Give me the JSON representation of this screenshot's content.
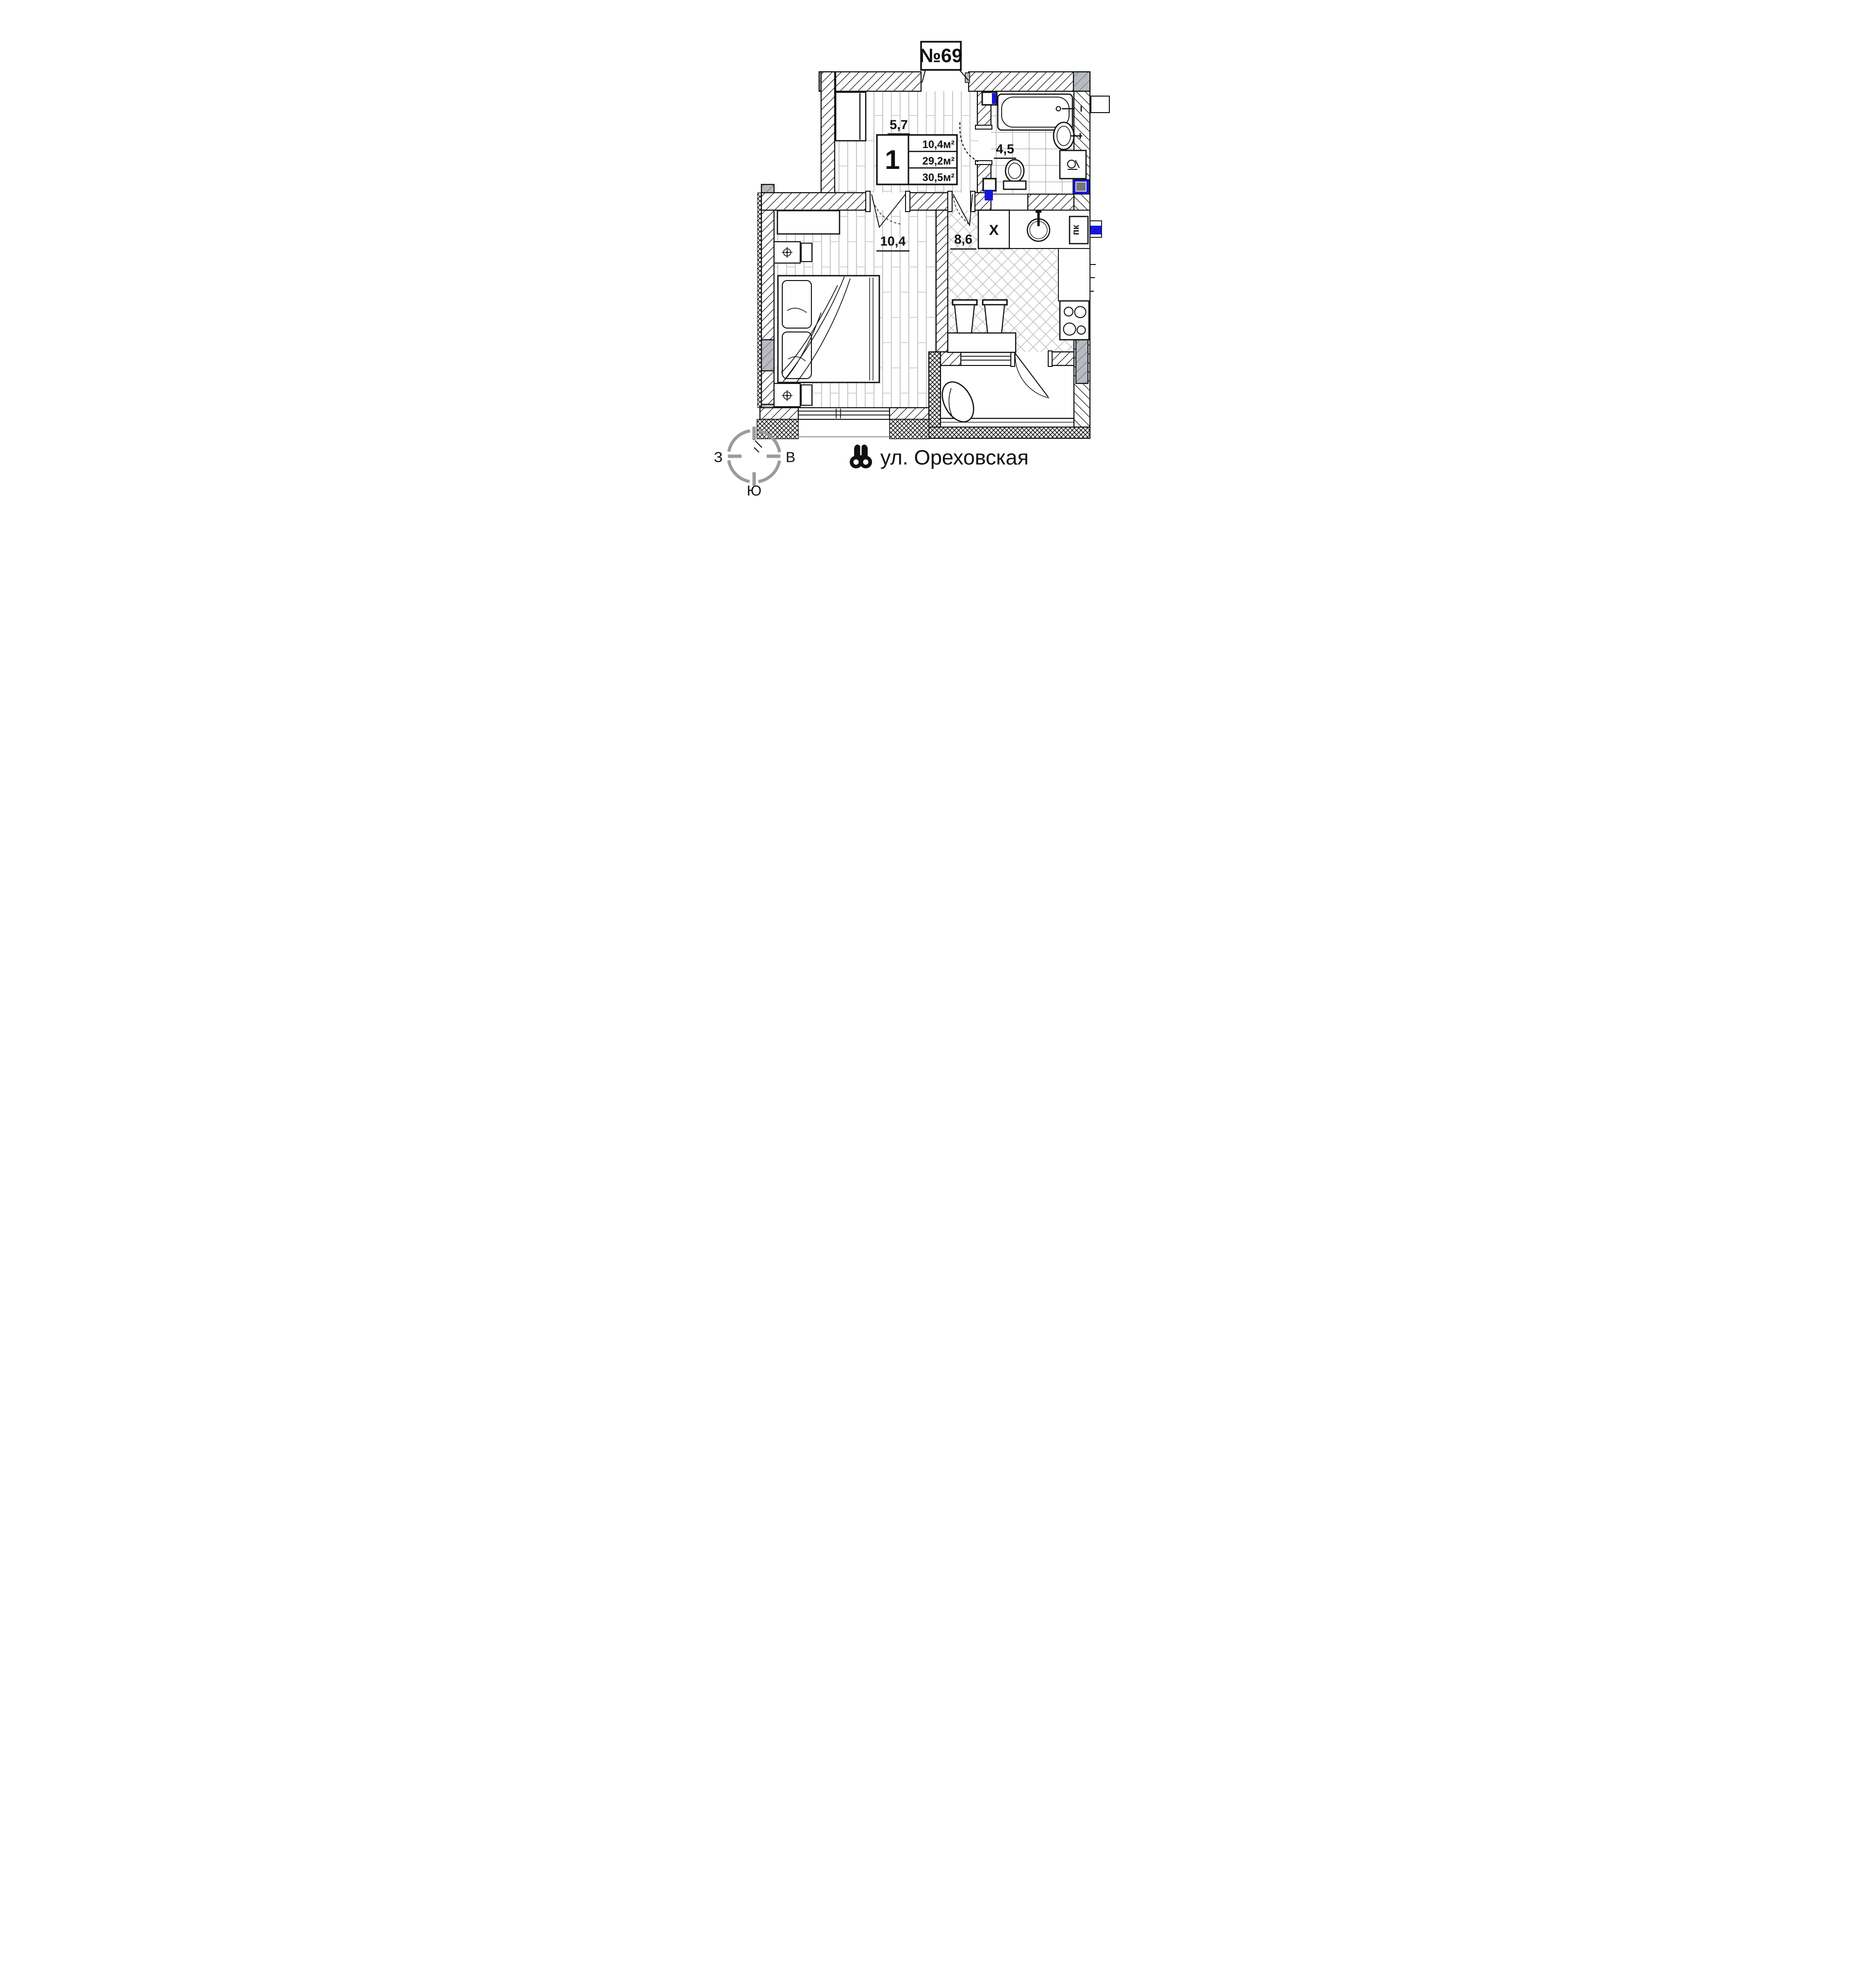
{
  "title": {
    "unit_number": "№69"
  },
  "areas": {
    "hall": "5,7",
    "bathroom": "4,5",
    "bedroom": "10,4",
    "kitchen": "8,6"
  },
  "info_box": {
    "rooms_count": "1",
    "living_area": "10,4м²",
    "apartment_area": "29,2м²",
    "total_area": "30,5м²"
  },
  "kitchen_marks": {
    "vent_label": "X",
    "stove_label": "пк"
  },
  "compass": {
    "west": "З",
    "east": "В",
    "south": "Ю"
  },
  "street": {
    "name": "ул. Ореховская"
  },
  "colors": {
    "accent_blue": "#1616d9",
    "wall_gray": "#b7bac0",
    "compass_gray": "#9b9b9b",
    "line": "#111111"
  }
}
